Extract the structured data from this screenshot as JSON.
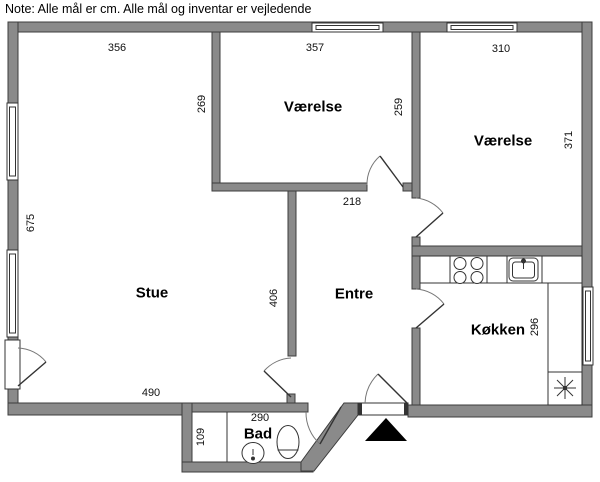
{
  "note": "Note: Alle mål er cm. Alle mål og inventar er vejledende",
  "rooms": {
    "stue": "Stue",
    "vaerelse1": "Værelse",
    "vaerelse2": "Værelse",
    "entre": "Entre",
    "koekken": "Køkken",
    "bad": "Bad"
  },
  "dims": {
    "d356": "356",
    "d357": "357",
    "d310": "310",
    "d269": "269",
    "d259": "259",
    "d371": "371",
    "d675": "675",
    "d218": "218",
    "d406": "406",
    "d490": "490",
    "d296": "296",
    "d290": "290",
    "d109": "109"
  },
  "fixtures": {
    "stove": "stove-burners",
    "kitchen_sink": "kitchen-sink",
    "worktop_symbol": "asterisk-symbol",
    "toilet": "toilet",
    "bath_sink": "wash-basin",
    "entrance_marker": "entrance-arrow"
  },
  "colors": {
    "wall_fill": "#8a8a8a",
    "wall_outline": "#3c3c3c",
    "fixture_line": "#333333",
    "door_arc": "#777777",
    "marker": "#000000"
  }
}
